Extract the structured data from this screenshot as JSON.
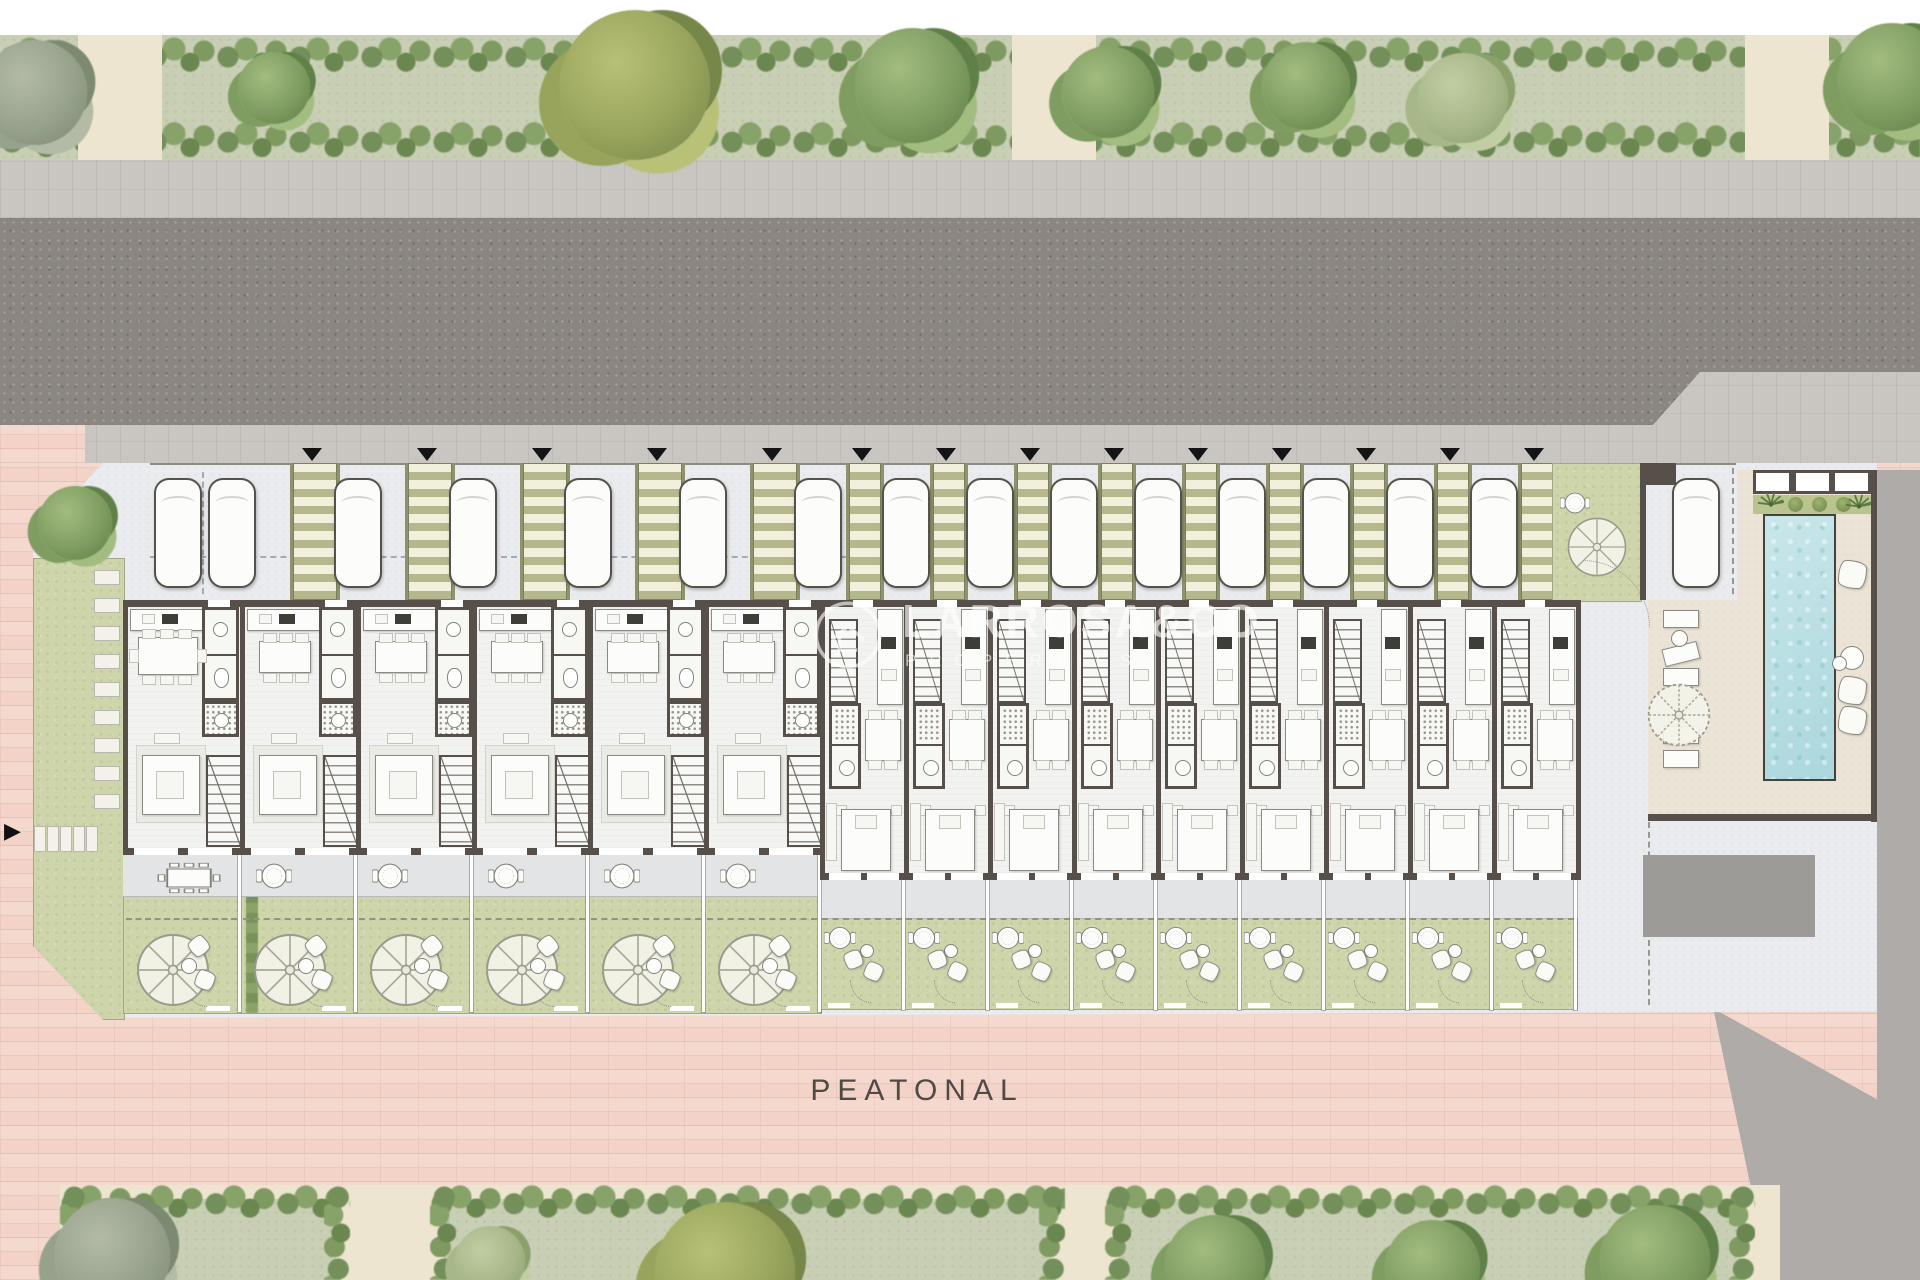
{
  "watermark": {
    "brand": "LARROSA&CO",
    "tagline": "PROPERTIES"
  },
  "labels": {
    "pedestrian_street": "PEATONAL",
    "entry_marker": "▼",
    "site_arrow": "▶"
  },
  "site": {
    "townhouse_count": 15,
    "type_a_units": [
      {
        "id": "U01"
      },
      {
        "id": "U02"
      },
      {
        "id": "U03"
      },
      {
        "id": "U04"
      },
      {
        "id": "U05"
      },
      {
        "id": "U06"
      }
    ],
    "type_b_units": [
      {
        "id": "U07"
      },
      {
        "id": "U08"
      },
      {
        "id": "U09"
      },
      {
        "id": "U10"
      },
      {
        "id": "U11"
      },
      {
        "id": "U12"
      },
      {
        "id": "U13"
      },
      {
        "id": "U14"
      },
      {
        "id": "U15"
      }
    ],
    "parking": {
      "car_count": 16
    },
    "amenities": [
      "communal-pool",
      "pergola",
      "planter",
      "communal-garden",
      "sun-loungers",
      "garage",
      "pedestrian-plaza"
    ]
  },
  "colors": {
    "road": "#8b8681",
    "sidewalk": "#c9c5c1",
    "plaza_pink": "#f3d3c7",
    "grass_strip": "#c9cfb5",
    "garden_lawn": "#cfd5ab",
    "wall": "#57504a",
    "parking_paving": "#e9ebee",
    "unit_floor": "#f2f2f0",
    "terrace": "#e2e4e6",
    "stripe_olive": "#b4b88c",
    "stripe_cream": "#f2efdc",
    "pool_water": "#b6dfe3",
    "pool_deck": "#ebe3d5",
    "street_edge_gray": "#aeaba8",
    "shed_gray": "#9d9b98"
  }
}
